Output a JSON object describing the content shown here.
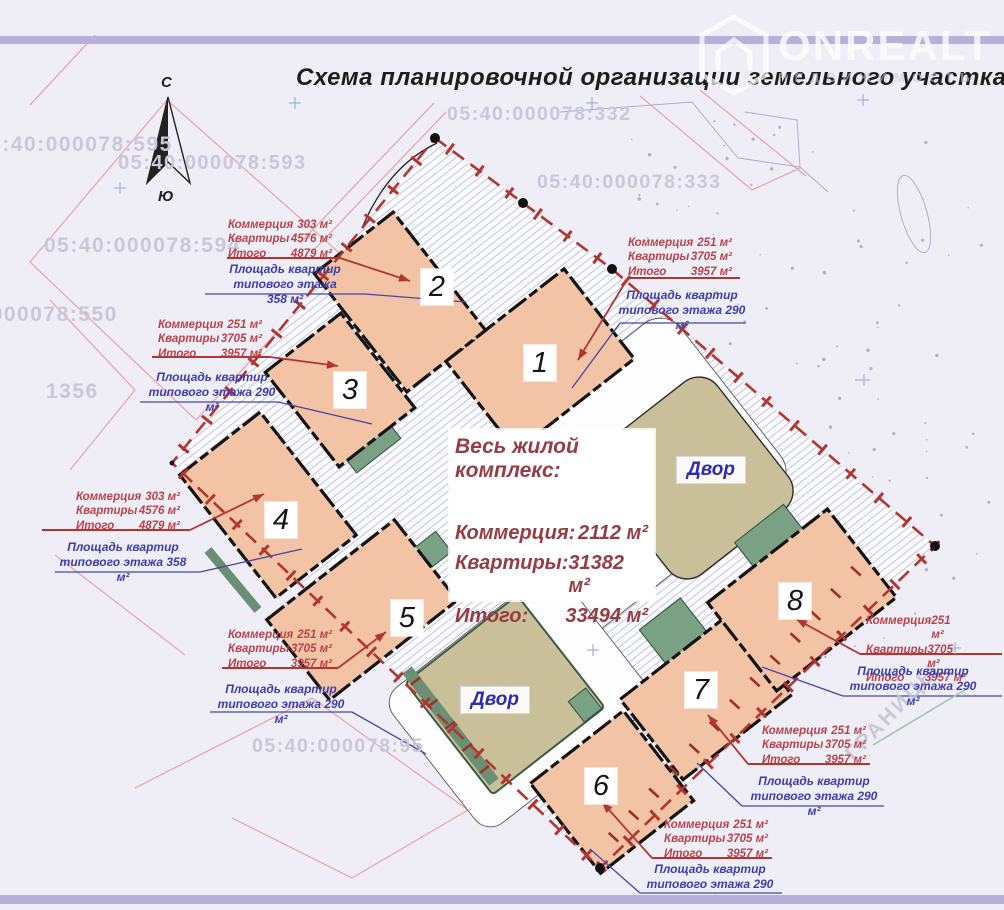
{
  "page": {
    "title": "Схема планировочной организации земельного участка"
  },
  "logo": {
    "name": "ONREALT",
    "subtitle": "НЕДВИЖИМОСТЬ"
  },
  "compass": {
    "north": "С",
    "south": "Ю"
  },
  "labels": {
    "courtyard": "Двор",
    "boundary_watermark": "ГРАНИЦЫ"
  },
  "cadastral": [
    {
      "text": "05:40:000078:595"
    },
    {
      "text": "05:40:000078:593"
    },
    {
      "text": "05:40:000078:594"
    },
    {
      "text": "05:40:000078:550"
    },
    {
      "text": "1356"
    },
    {
      "text": "05:40:000078:332"
    },
    {
      "text": "05:40:000078:333"
    },
    {
      "text": "05:40:000078:95"
    }
  ],
  "summary": {
    "title": "Весь жилой комплекс:",
    "rows": [
      {
        "label": "Коммерция:",
        "value": "2112 м²"
      },
      {
        "label": "Квартиры:",
        "value": "31382 м²"
      },
      {
        "label": "Итого:",
        "value": "33494 м²"
      }
    ]
  },
  "buildings": [
    {
      "number": "1"
    },
    {
      "number": "2"
    },
    {
      "number": "3"
    },
    {
      "number": "4"
    },
    {
      "number": "5"
    },
    {
      "number": "6"
    },
    {
      "number": "7"
    },
    {
      "number": "8"
    }
  ],
  "annotations": [
    {
      "building": "1",
      "rows": [
        {
          "label": "Коммерция",
          "value": "251 м²"
        },
        {
          "label": "Квартиры",
          "value": "3705 м²"
        },
        {
          "label": "Итого",
          "value": "3957 м²"
        }
      ],
      "floor_line1": "Площадь квартир",
      "floor_line2": "типового этажа  290 м²"
    },
    {
      "building": "2",
      "rows": [
        {
          "label": "Коммерция",
          "value": "303 м²"
        },
        {
          "label": "Квартиры",
          "value": "4576 м²"
        },
        {
          "label": "Итого",
          "value": "4879 м²"
        }
      ],
      "floor_line1": "Площадь квартир",
      "floor_line2": "типового этажа  358 м²"
    },
    {
      "building": "3",
      "rows": [
        {
          "label": "Коммерция",
          "value": "251 м²"
        },
        {
          "label": "Квартиры",
          "value": "3705 м²"
        },
        {
          "label": "Итого",
          "value": "3957 м²"
        }
      ],
      "floor_line1": "Площадь квартир",
      "floor_line2": "типового этажа  290 м²"
    },
    {
      "building": "4",
      "rows": [
        {
          "label": "Коммерция",
          "value": "303 м²"
        },
        {
          "label": "Квартиры",
          "value": "4576 м²"
        },
        {
          "label": "Итого",
          "value": "4879 м²"
        }
      ],
      "floor_line1": "Площадь квартир",
      "floor_line2": "типового этажа  358 м²"
    },
    {
      "building": "5",
      "rows": [
        {
          "label": "Коммерция",
          "value": "251 м²"
        },
        {
          "label": "Квартиры",
          "value": "3705 м²"
        },
        {
          "label": "Итого",
          "value": "3957 м²"
        }
      ],
      "floor_line1": "Площадь квартир",
      "floor_line2": "типового этажа  290 м²"
    },
    {
      "building": "6",
      "rows": [
        {
          "label": "Коммерция",
          "value": "251 м²"
        },
        {
          "label": "Квартиры",
          "value": "3705 м²"
        },
        {
          "label": "Итого",
          "value": "3957 м²"
        }
      ],
      "floor_line1": "Площадь квартир",
      "floor_line2": "типового этажа  290 м²"
    },
    {
      "building": "7",
      "rows": [
        {
          "label": "Коммерция",
          "value": "251 м²"
        },
        {
          "label": "Квартиры",
          "value": "3705 м²"
        },
        {
          "label": "Итого",
          "value": "3957 м²"
        }
      ],
      "floor_line1": "Площадь квартир",
      "floor_line2": "типового этажа  290 м²"
    },
    {
      "building": "8",
      "rows": [
        {
          "label": "Коммерция",
          "value": "251 м²"
        },
        {
          "label": "Квартиры",
          "value": "3705 м²"
        },
        {
          "label": "Итого",
          "value": "3957 м²"
        }
      ],
      "floor_line1": "Площадь квартир",
      "floor_line2": "типового этажа  290 м²"
    }
  ]
}
